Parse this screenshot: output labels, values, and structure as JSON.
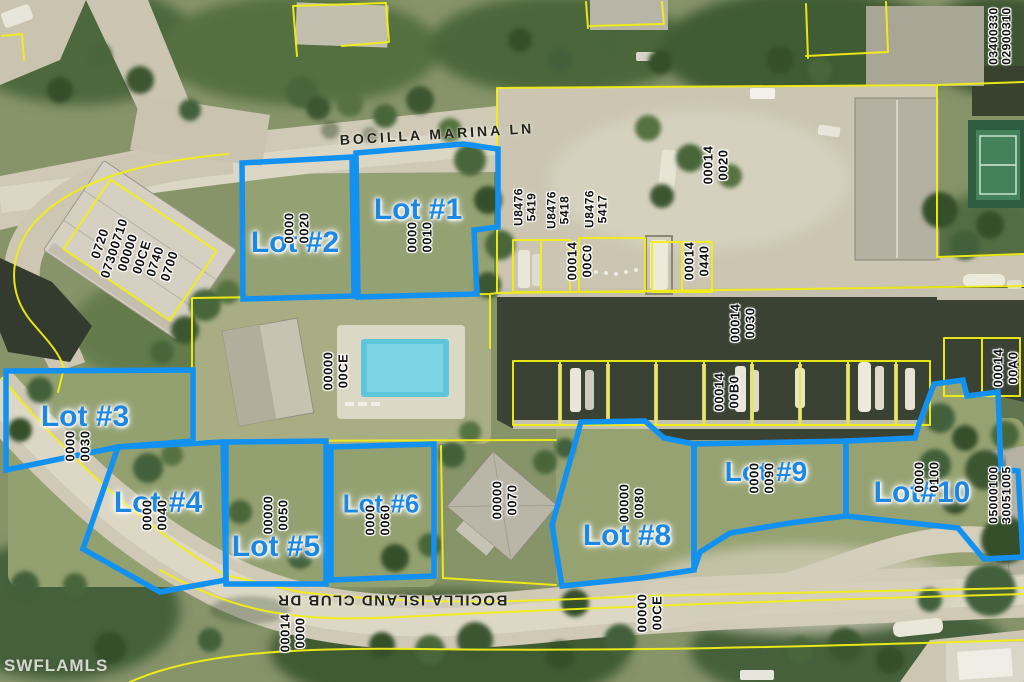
{
  "watermark": "SWFLAMLS",
  "streets": {
    "marina_ln": "BOCILLA MARINA LN",
    "island_club_dr": "BOCILLA ISLAND CLUB DR"
  },
  "colors": {
    "lot_outline": "#1291f0",
    "lot_label": "#1d87e2",
    "parcel_line": "#f2ee16",
    "parcel_text": "#101010",
    "water": "#3a4233",
    "road": "#cfc9b6",
    "grass": "#87946a"
  },
  "lots": [
    {
      "label": "Lot #1",
      "parcel_line1": "0000",
      "parcel_line2": "0010"
    },
    {
      "label": "Lot #2",
      "parcel_line1": "0000",
      "parcel_line2": "0020"
    },
    {
      "label": "Lot #3",
      "parcel_line1": "0000",
      "parcel_line2": "0030"
    },
    {
      "label": "Lot #4",
      "parcel_line1": "0000",
      "parcel_line2": "0040"
    },
    {
      "label": "Lot #5",
      "parcel_line1": "00000",
      "parcel_line2": "0050"
    },
    {
      "label": "Lot #6",
      "parcel_line1": "0000",
      "parcel_line2": "0060"
    },
    {
      "label": "Lot #8",
      "parcel_line1": "00000",
      "parcel_line2": "0080"
    },
    {
      "label": "Lot #9",
      "parcel_line1": "0000",
      "parcel_line2": "0090"
    },
    {
      "label": "Lot#10",
      "parcel_line1": "0000",
      "parcel_line2": "0100"
    }
  ],
  "parcel_labels": [
    {
      "id": "condo-parcel",
      "lines": [
        "0720",
        "07300710",
        "00000",
        "00CE",
        "0740",
        "0700"
      ]
    },
    {
      "id": "marina-upland",
      "lines": [
        "00014",
        "0020"
      ]
    },
    {
      "id": "dock-5419",
      "lines": [
        "U8476",
        "5419"
      ]
    },
    {
      "id": "dock-5418",
      "lines": [
        "U8476",
        "5418"
      ]
    },
    {
      "id": "dock-5417",
      "lines": [
        "U8476",
        "5417"
      ]
    },
    {
      "id": "slip-00c0",
      "lines": [
        "00014",
        "00C0"
      ]
    },
    {
      "id": "slip-0440",
      "lines": [
        "00014",
        "0440"
      ]
    },
    {
      "id": "canal-parcel",
      "lines": [
        "00014",
        "0030"
      ]
    },
    {
      "id": "slip-00b0",
      "lines": [
        "00014",
        "00B0"
      ]
    },
    {
      "id": "slip-00a0",
      "lines": [
        "00014",
        "00A0"
      ]
    },
    {
      "id": "ne-parcels",
      "lines": [
        "03400330",
        "02900310"
      ]
    },
    {
      "id": "pool-common-area",
      "lines": [
        "00000",
        "00CE"
      ]
    },
    {
      "id": "lot7-house-parcel",
      "lines": [
        "00000",
        "0070"
      ]
    },
    {
      "id": "road-parcel",
      "lines": [
        "00014",
        "0000"
      ]
    },
    {
      "id": "common-area-ce",
      "lines": [
        "00000",
        "00CE"
      ]
    },
    {
      "id": "se-parcels",
      "lines": [
        "05000100",
        "30051005"
      ]
    }
  ]
}
